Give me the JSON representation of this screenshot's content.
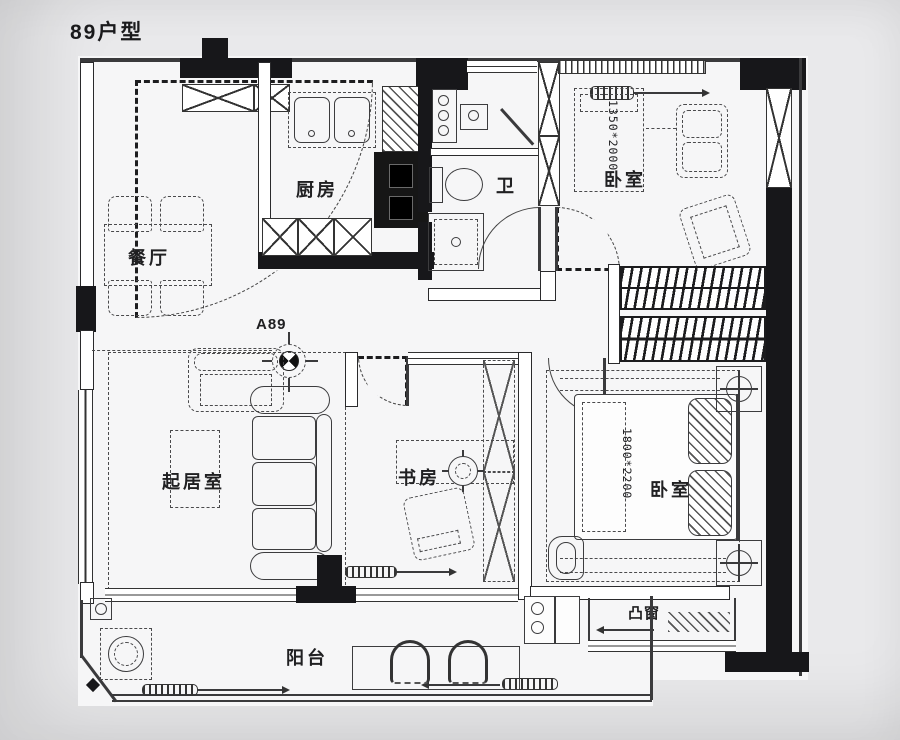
{
  "page": {
    "title": "89户型"
  },
  "marker": {
    "label": "A89"
  },
  "rooms": {
    "kitchen": {
      "label": "厨房"
    },
    "bath": {
      "label": "卫"
    },
    "bedroom2": {
      "label": "卧室",
      "dim": "1350*2000"
    },
    "dining": {
      "label": "餐厅"
    },
    "living": {
      "label": "起居室"
    },
    "study": {
      "label": "书房"
    },
    "master": {
      "label": "卧室",
      "dim": "1800*2200"
    },
    "bay_window": {
      "label": "凸窗"
    },
    "balcony": {
      "label": "阳台"
    }
  },
  "colors": {
    "wall": "#17171a",
    "line": "#3a3a3c",
    "paper": "#f6f6f7",
    "background": "#e9e9eb",
    "text": "#202022"
  }
}
